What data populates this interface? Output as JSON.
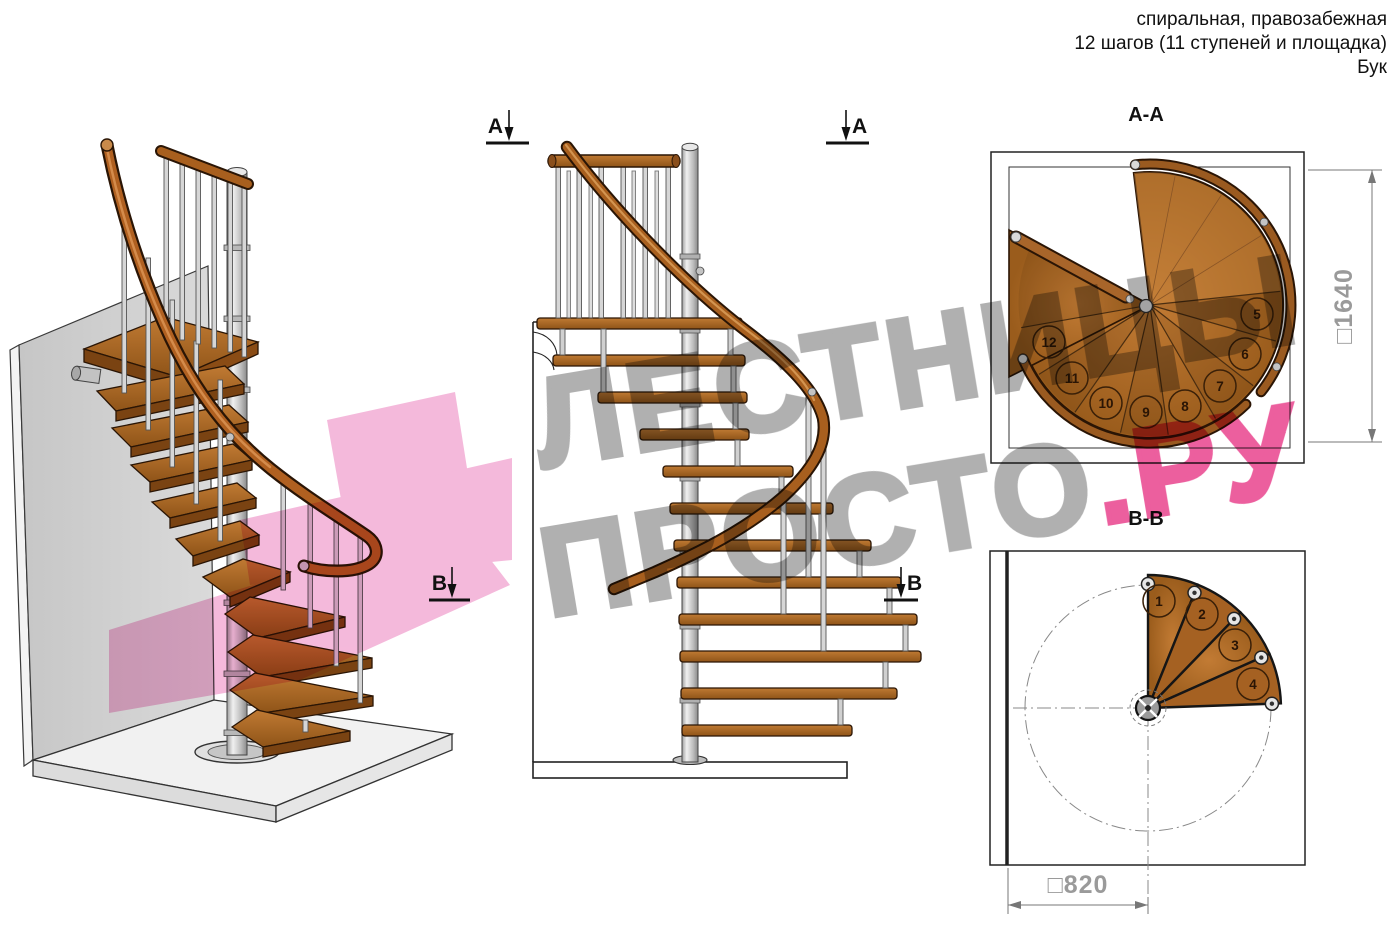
{
  "header": {
    "line1": "спиральная, правозабежная",
    "line2": "12 шагов (11 ступеней и площадка)",
    "line3": "Бук"
  },
  "views": {
    "view3d": {
      "description": "3D вид спиральной лестницы"
    },
    "elevation": {
      "marker_a": "А",
      "marker_b": "В"
    },
    "plan_aa": {
      "title": "А-А",
      "dimension": "□1640",
      "step_numbers": [
        "5",
        "6",
        "7",
        "8",
        "9",
        "10",
        "11",
        "12"
      ]
    },
    "plan_bb": {
      "title": "В-В",
      "dimension": "□820",
      "step_numbers": [
        "1",
        "2",
        "3",
        "4"
      ]
    }
  },
  "watermark": {
    "line1": "ЛЕСТНИЦЫ",
    "line2": "ПРОСТО",
    "suffix": ".РУ"
  },
  "colors": {
    "wood": "#b06a28",
    "wood_dark": "#5a3413",
    "steel": "#c8c8c8",
    "wall_gray": "#cfcfcf",
    "watermark_gray": "#b0b0b0",
    "watermark_pink": "#ec5f9e",
    "overlay_pink": "#f2a8d2",
    "dimension_gray": "#9a9a9a",
    "line_black": "#1a1a1a"
  }
}
